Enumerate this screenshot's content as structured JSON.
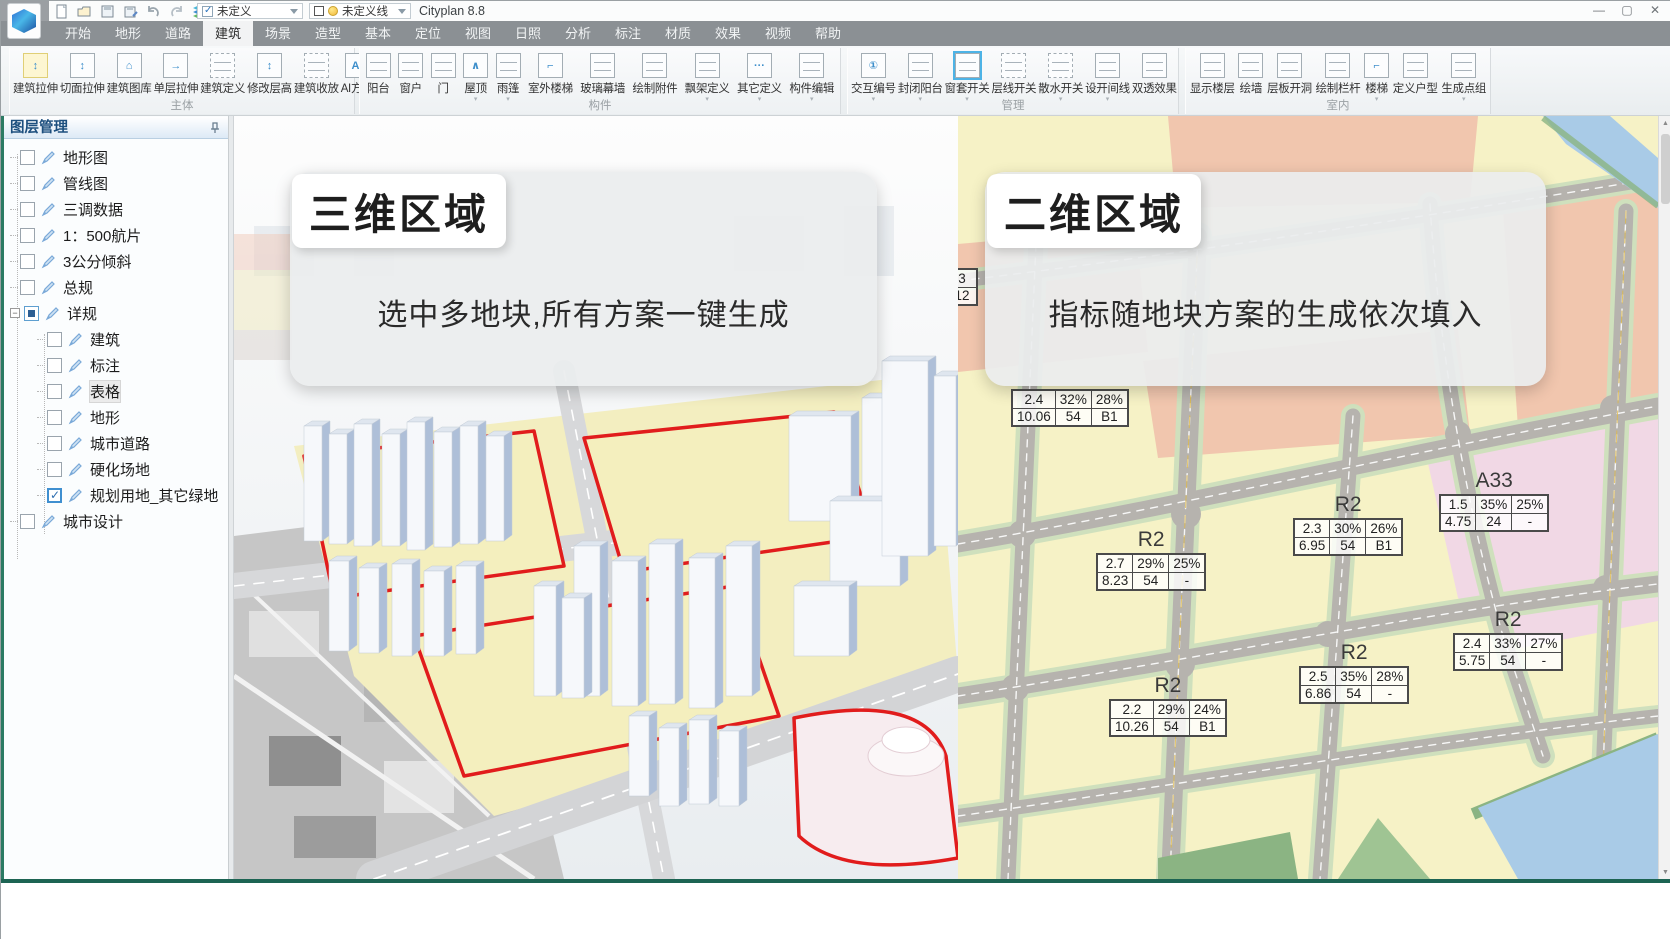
{
  "titlebar": {
    "app_title": "Cityplan 8.8",
    "combo_undefined": "未定义",
    "combo_undefined_line": "未定义线",
    "quick_icons": [
      "new-file-icon",
      "open-folder-icon",
      "save-icon",
      "save-as-icon",
      "undo-icon",
      "redo-icon",
      "layers-icon",
      "structure-tree-icon"
    ],
    "window_controls": [
      "minimize",
      "maximize",
      "close"
    ]
  },
  "tabs": [
    {
      "label": "开始"
    },
    {
      "label": "地形"
    },
    {
      "label": "道路"
    },
    {
      "label": "建筑",
      "active": true
    },
    {
      "label": "场景"
    },
    {
      "label": "造型"
    },
    {
      "label": "基本"
    },
    {
      "label": "定位"
    },
    {
      "label": "视图"
    },
    {
      "label": "日照"
    },
    {
      "label": "分析"
    },
    {
      "label": "标注"
    },
    {
      "label": "材质"
    },
    {
      "label": "效果"
    },
    {
      "label": "视频"
    },
    {
      "label": "帮助"
    }
  ],
  "ribbon": {
    "groups": [
      {
        "label": "主体",
        "left": 8,
        "width": 346,
        "buttons": [
          {
            "label": "建筑拉伸",
            "icon": "building-extrude-icon",
            "glyph": "↕",
            "highlight": true
          },
          {
            "label": "切面拉伸",
            "icon": "section-extrude-icon",
            "glyph": "↕"
          },
          {
            "label": "建筑图库",
            "icon": "building-library-icon",
            "glyph": "⌂"
          },
          {
            "label": "单层拉伸",
            "icon": "single-floor-extrude-icon",
            "glyph": "→"
          },
          {
            "label": "建筑定义",
            "icon": "building-define-icon",
            "dashed": true
          },
          {
            "label": "修改层高",
            "icon": "floor-height-icon",
            "glyph": "↕"
          },
          {
            "label": "建筑收放",
            "icon": "building-scale-icon",
            "dashed": true
          },
          {
            "label": "AI方案",
            "icon": "ai-plan-icon",
            "glyph": "AI"
          }
        ]
      },
      {
        "label": "构件",
        "left": 358,
        "width": 482,
        "buttons": [
          {
            "label": "阳台",
            "icon": "balcony-icon"
          },
          {
            "label": "窗户",
            "icon": "window-icon"
          },
          {
            "label": "门",
            "icon": "door-icon"
          },
          {
            "label": "屋顶",
            "icon": "roof-icon",
            "glyph": "∧",
            "dropdown": true
          },
          {
            "label": "雨篷",
            "icon": "canopy-icon",
            "dropdown": true
          },
          {
            "label": "室外楼梯",
            "icon": "outdoor-stairs-icon",
            "glyph": "⌐"
          },
          {
            "label": "玻璃幕墙",
            "icon": "glass-curtain-wall-icon"
          },
          {
            "label": "绘制附件",
            "icon": "draw-attachment-icon"
          },
          {
            "label": "飘架定义",
            "icon": "overhang-define-icon",
            "dropdown": true
          },
          {
            "label": "其它定义",
            "icon": "other-define-icon",
            "glyph": "···",
            "dropdown": true
          },
          {
            "label": "构件编辑",
            "icon": "component-edit-icon",
            "dropdown": true
          }
        ]
      },
      {
        "label": "管理",
        "left": 846,
        "width": 332,
        "buttons": [
          {
            "label": "交互编号",
            "icon": "interactive-number-icon",
            "glyph": "①",
            "dropdown": true
          },
          {
            "label": "封闭阳台",
            "icon": "enclose-balcony-icon",
            "dropdown": true
          },
          {
            "label": "窗套开关",
            "icon": "window-trim-toggle-icon",
            "selected": true,
            "dropdown": true
          },
          {
            "label": "层线开关",
            "icon": "floor-line-toggle-icon",
            "dashed": true
          },
          {
            "label": "散水开关",
            "icon": "apron-toggle-icon",
            "dashed": true,
            "dropdown": true
          },
          {
            "label": "设开间线",
            "icon": "bay-line-icon",
            "dropdown": true
          },
          {
            "label": "双透效果",
            "icon": "xray-effect-icon"
          }
        ]
      },
      {
        "label": "室内",
        "left": 1184,
        "width": 306,
        "buttons": [
          {
            "label": "显示楼层",
            "icon": "show-floors-icon"
          },
          {
            "label": "绘墙",
            "icon": "draw-wall-icon"
          },
          {
            "label": "层板开洞",
            "icon": "slab-hole-icon"
          },
          {
            "label": "绘制栏杆",
            "icon": "draw-railing-icon"
          },
          {
            "label": "楼梯",
            "icon": "stairs-icon",
            "glyph": "⌐",
            "dropdown": true
          },
          {
            "label": "定义户型",
            "icon": "define-unit-icon"
          },
          {
            "label": "生成点组",
            "icon": "generate-points-icon",
            "dropdown": true
          }
        ]
      }
    ]
  },
  "layer_panel": {
    "title": "图层管理",
    "items": [
      {
        "label": "地形图",
        "level": 1,
        "checked": "no"
      },
      {
        "label": "管线图",
        "level": 1,
        "checked": "no"
      },
      {
        "label": "三调数据",
        "level": 1,
        "checked": "no"
      },
      {
        "label": "1：500航片",
        "level": 1,
        "checked": "no"
      },
      {
        "label": "3公分倾斜",
        "level": 1,
        "checked": "no"
      },
      {
        "label": "总规",
        "level": 1,
        "checked": "no"
      },
      {
        "label": "详规",
        "level": 1,
        "checked": "partial",
        "expanded": true
      },
      {
        "label": "建筑",
        "level": 2,
        "checked": "no"
      },
      {
        "label": "标注",
        "level": 2,
        "checked": "no"
      },
      {
        "label": "表格",
        "level": 2,
        "checked": "no",
        "hover": true
      },
      {
        "label": "地形",
        "level": 2,
        "checked": "no"
      },
      {
        "label": "城市道路",
        "level": 2,
        "checked": "no"
      },
      {
        "label": "硬化场地",
        "level": 2,
        "checked": "no"
      },
      {
        "label": "规划用地_其它绿地",
        "level": 2,
        "checked": "yes"
      },
      {
        "label": "城市设计",
        "level": 1,
        "checked": "no"
      }
    ]
  },
  "viewport": {
    "banner_3d": {
      "title": "三维区域",
      "subtitle": "选中多地块,所有方案一键生成"
    },
    "banner_2d": {
      "title": "二维区域",
      "subtitle": "指标随地块方案的生成依次填入"
    },
    "map_annotations": [
      {
        "zone": "",
        "x": -12,
        "y": 152,
        "rows": [
          [
            "3"
          ],
          [
            "12"
          ]
        ]
      },
      {
        "zone": "",
        "x": 53,
        "y": 273,
        "rows": [
          [
            "2.4",
            "32%",
            "28%"
          ],
          [
            "10.06",
            "54",
            "B1"
          ]
        ]
      },
      {
        "zone": "R2",
        "x": 138,
        "y": 412,
        "rows": [
          [
            "2.7",
            "29%",
            "25%"
          ],
          [
            "8.23",
            "54",
            "-"
          ]
        ]
      },
      {
        "zone": "R2",
        "x": 335,
        "y": 377,
        "rows": [
          [
            "2.3",
            "30%",
            "26%"
          ],
          [
            "6.95",
            "54",
            "B1"
          ]
        ]
      },
      {
        "zone": "A33",
        "x": 481,
        "y": 353,
        "rows": [
          [
            "1.5",
            "35%",
            "25%"
          ],
          [
            "4.75",
            "24",
            "-"
          ]
        ]
      },
      {
        "zone": "R2",
        "x": 495,
        "y": 492,
        "rows": [
          [
            "2.4",
            "33%",
            "27%"
          ],
          [
            "5.75",
            "54",
            "-"
          ]
        ]
      },
      {
        "zone": "R2",
        "x": 341,
        "y": 525,
        "rows": [
          [
            "2.5",
            "35%",
            "28%"
          ],
          [
            "6.86",
            "54",
            "-"
          ]
        ]
      },
      {
        "zone": "R2",
        "x": 151,
        "y": 558,
        "rows": [
          [
            "2.2",
            "29%",
            "24%"
          ],
          [
            "10.26",
            "54",
            "B1"
          ]
        ]
      }
    ],
    "colors": {
      "parcel_yellow": "#f3eec0",
      "parcel_salmon": "#f1c6ae",
      "parcel_pink": "#f1d8e5",
      "road_gray": "#b6b3ae",
      "water_blue": "#a9cbe7",
      "green": "#8bb483",
      "red_outline": "#e11c1c"
    }
  }
}
